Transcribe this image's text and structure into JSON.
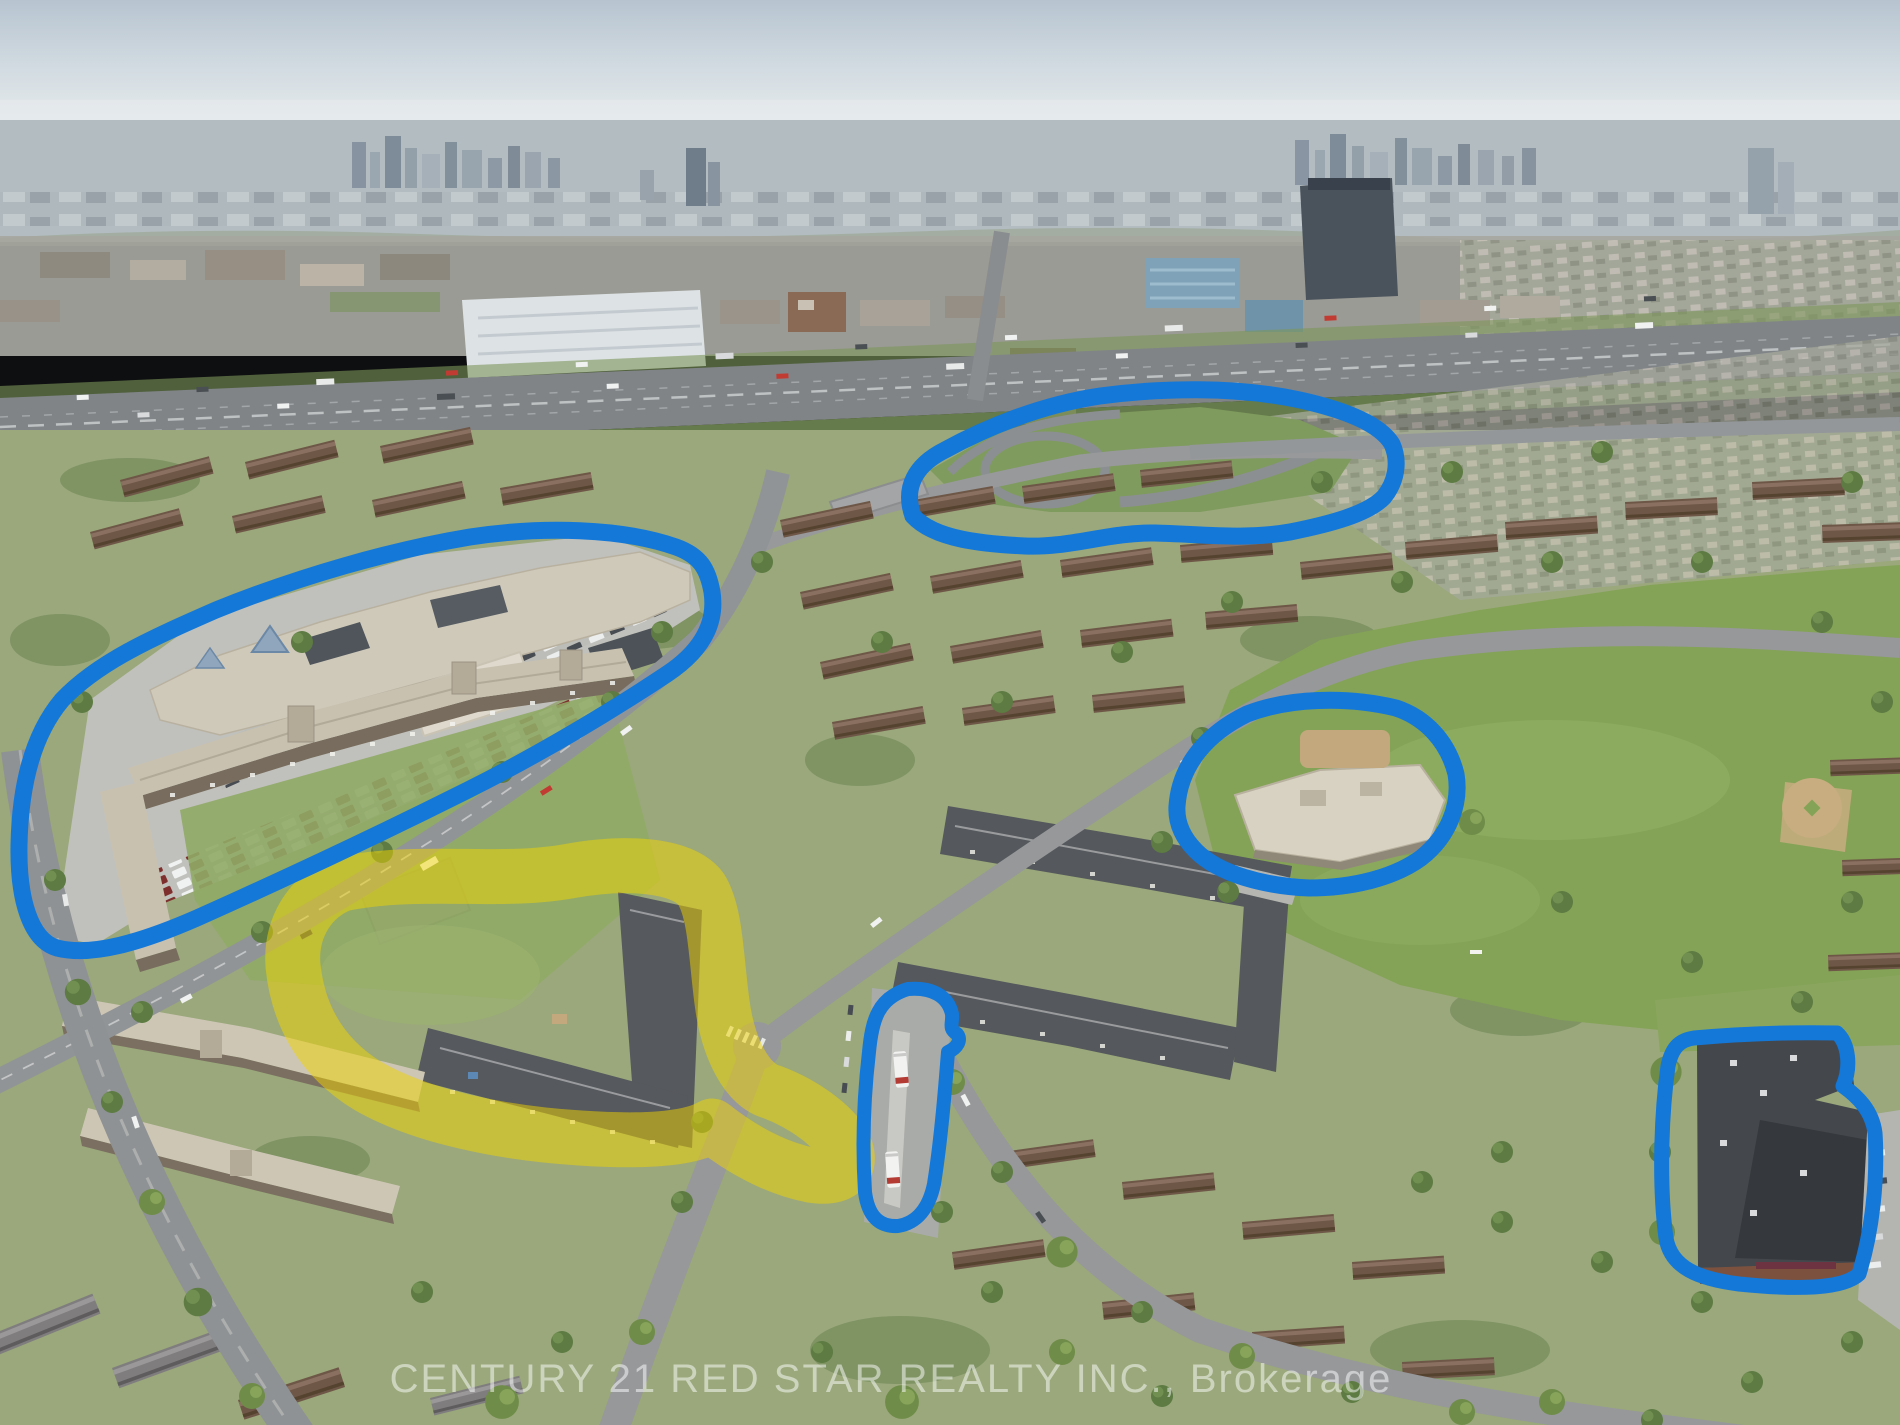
{
  "scene": {
    "type": "aerial-drone-photo",
    "watermark": "CENTURY 21 RED STAR REALTY INC., Brokerage"
  },
  "annotations": {
    "blue": "#1478d8",
    "yellow": "#f2d400",
    "yellow_opacity": "0.5",
    "outlines": [
      {
        "name": "highway-interchange",
        "color": "blue"
      },
      {
        "name": "shopping-plaza",
        "color": "blue"
      },
      {
        "name": "school-grounds",
        "color": "blue"
      },
      {
        "name": "bus-loop",
        "color": "blue"
      },
      {
        "name": "commercial-plaza",
        "color": "blue"
      },
      {
        "name": "apartment-complex-grounds",
        "color": "yellow"
      }
    ]
  }
}
